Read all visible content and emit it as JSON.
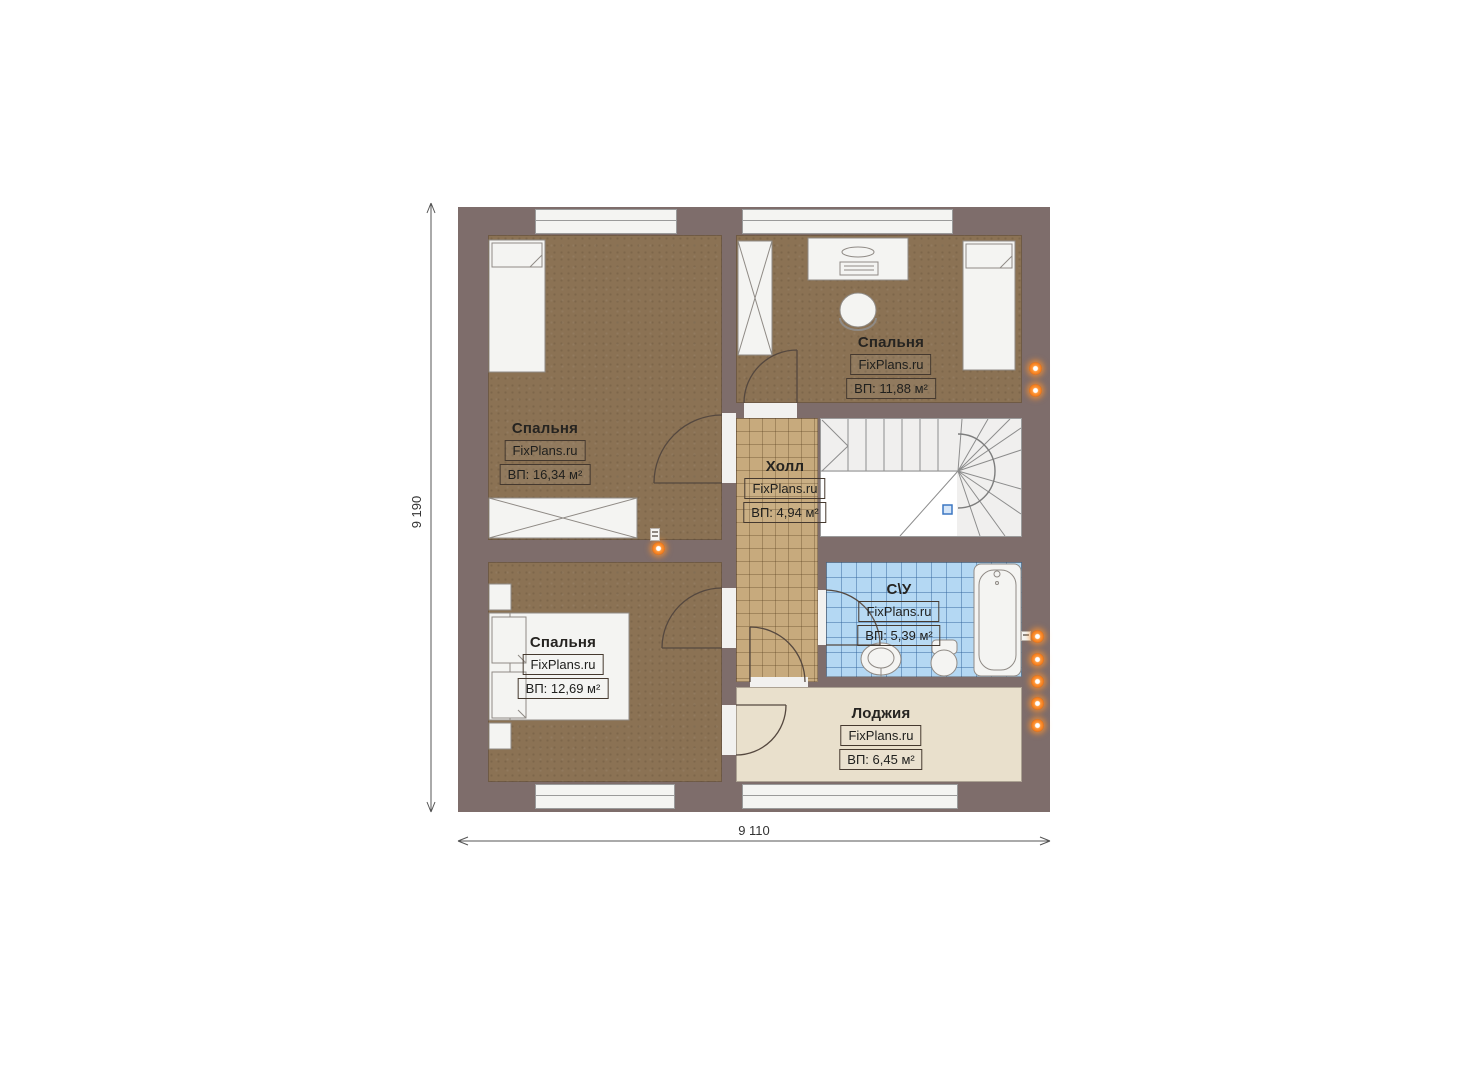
{
  "site": "FixPlans.ru",
  "rooms": [
    {
      "name": "Спальня",
      "area": "ВП: 16,34 м²"
    },
    {
      "name": "Спальня",
      "area": "ВП: 11,88 м²"
    },
    {
      "name": "Холл",
      "area": "ВП: 4,94 м²"
    },
    {
      "name": "С\\У",
      "area": "ВП: 5,39 м²"
    },
    {
      "name": "Спальня",
      "area": "ВП: 12,69 м²"
    },
    {
      "name": "Лоджия",
      "area": "ВП: 6,45 м²"
    }
  ],
  "dimensions": {
    "height": "9 190",
    "width": "9 110"
  },
  "colors": {
    "wall": "#7e6d6b",
    "bedroom_floor": "#8b7254",
    "hall_floor": "#c7aa7d",
    "bathroom_floor": "#b4d8f3",
    "loggia_floor": "#e9e0cc",
    "stairs_floor": "#f0efee",
    "socket_glow": "#f07818",
    "stair_marker": "#3b77c2"
  }
}
